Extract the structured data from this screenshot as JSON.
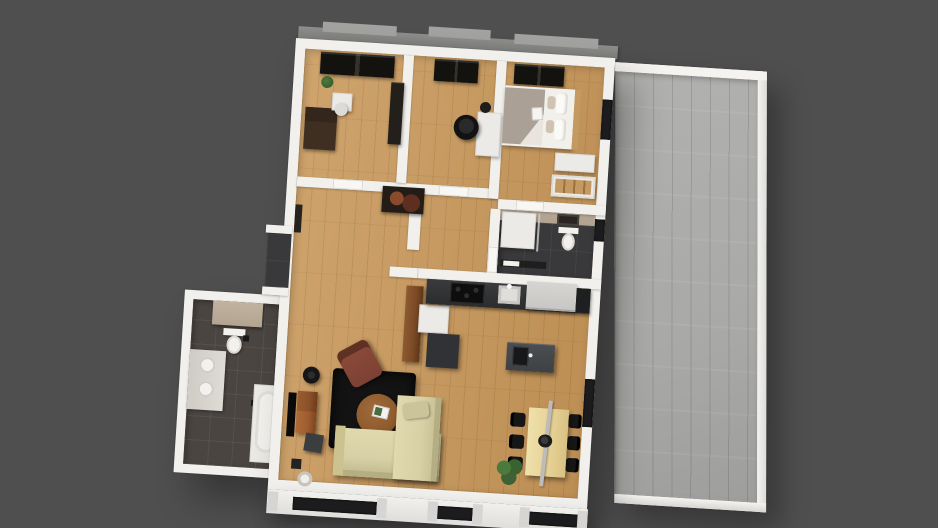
{
  "scene": {
    "description": "3D rendered bird's-eye floor plan of an apartment with a large side terrace on dark gray backdrop",
    "style": "photoreal top-down architectural render, no visible text",
    "rotation_deg": 3.6
  },
  "palette": {
    "background": "#4f4f50",
    "wall": "#f1f0ed",
    "wall_shadow": "#d8d7d4",
    "wood_light": "#cfa46d",
    "wood_dark": "#bc8e54",
    "terrace_deck": "#a9a9a7",
    "tile_dark": "#39393b",
    "tile_bath": "#4a4541",
    "beige_tile": "#b3a492",
    "counter_dark": "#2b2c2e",
    "island": "#3f4144",
    "cabinet_white": "#eceae6",
    "pantry_wood": "#7b4a26",
    "fridge": "#c7c6c4",
    "sofa": "#d7d0a6",
    "rug": "#131313",
    "armchair": "#7c4133",
    "coffee_table": "#8f5c2f",
    "tv_board": "#9e5c30",
    "dining_table": "#e7d295",
    "chair_black": "#161616",
    "wardrobe_dark": "#23201c",
    "bed_white": "#f2f0ea",
    "blanket_gray": "#aaa095",
    "pillow_beige": "#cfc3b2",
    "plant_green": "#3f6136",
    "roof_ledge": "#8e8e8c",
    "roof_sill": "#a2a2a0",
    "glass_dark": "#1c1c1e",
    "porcelain": "#f3f1ed",
    "facade_pilaster": "#d6d5d3"
  },
  "rooms": [
    {
      "id": "bedroom-left",
      "label": "Bedroom with wardrobe, dresser and desk"
    },
    {
      "id": "office",
      "label": "Office with desk and swivel chair"
    },
    {
      "id": "bedroom-main",
      "label": "Master bedroom with double bed"
    },
    {
      "id": "hallway",
      "label": "Hallway with wall art"
    },
    {
      "id": "shower-wc",
      "label": "Shower WC with wall-hung toilet"
    },
    {
      "id": "bathroom",
      "label": "Bathroom with double vanity and bathtub"
    },
    {
      "id": "living-room",
      "label": "Living room with corner sofa and TV"
    },
    {
      "id": "kitchen",
      "label": "Kitchen with counter and island"
    },
    {
      "id": "dining-area",
      "label": "Dining area with six chairs"
    },
    {
      "id": "terrace",
      "label": "Large stone-deck terrace"
    },
    {
      "id": "entrance",
      "label": "Recessed entrance niche"
    }
  ],
  "furniture": {
    "bedroom_left": [
      "wardrobe",
      "dark dresser",
      "white desk",
      "white chair",
      "tall cabinet",
      "plant"
    ],
    "office": [
      "wardrobe",
      "white corner desk",
      "black office chair",
      "desk fan"
    ],
    "bedroom_main": [
      "wardrobe",
      "double bed with gray blanket",
      "pillows",
      "white dresser",
      "open shelf unit",
      "book"
    ],
    "shower_wc": [
      "wall-hung toilet",
      "glass partition",
      "framed picture",
      "towel rail"
    ],
    "bathroom": [
      "tiled half wall",
      "toilet",
      "double vanity with two vessel sinks",
      "bathtub on platform",
      "bath mats"
    ],
    "living_room": [
      "wall TV",
      "wooden TV sideboard",
      "floor lamp",
      "speaker",
      "black shag rug",
      "round coffee table",
      "magazine",
      "leather recliner",
      "beige corner sofa",
      "throw pillow",
      "basket"
    ],
    "kitchen": [
      "tall pantry cabinet",
      "white base cabinet",
      "dark base cabinet",
      "worktop",
      "cooktop",
      "sink",
      "built-in fridge",
      "island with sink"
    ],
    "dining_area": [
      "light wood dining table",
      "six black chairs",
      "pendant light rail",
      "fruit bowl",
      "potted plant"
    ],
    "terrace": [
      "stone plank decking",
      "white parapet walls"
    ]
  }
}
